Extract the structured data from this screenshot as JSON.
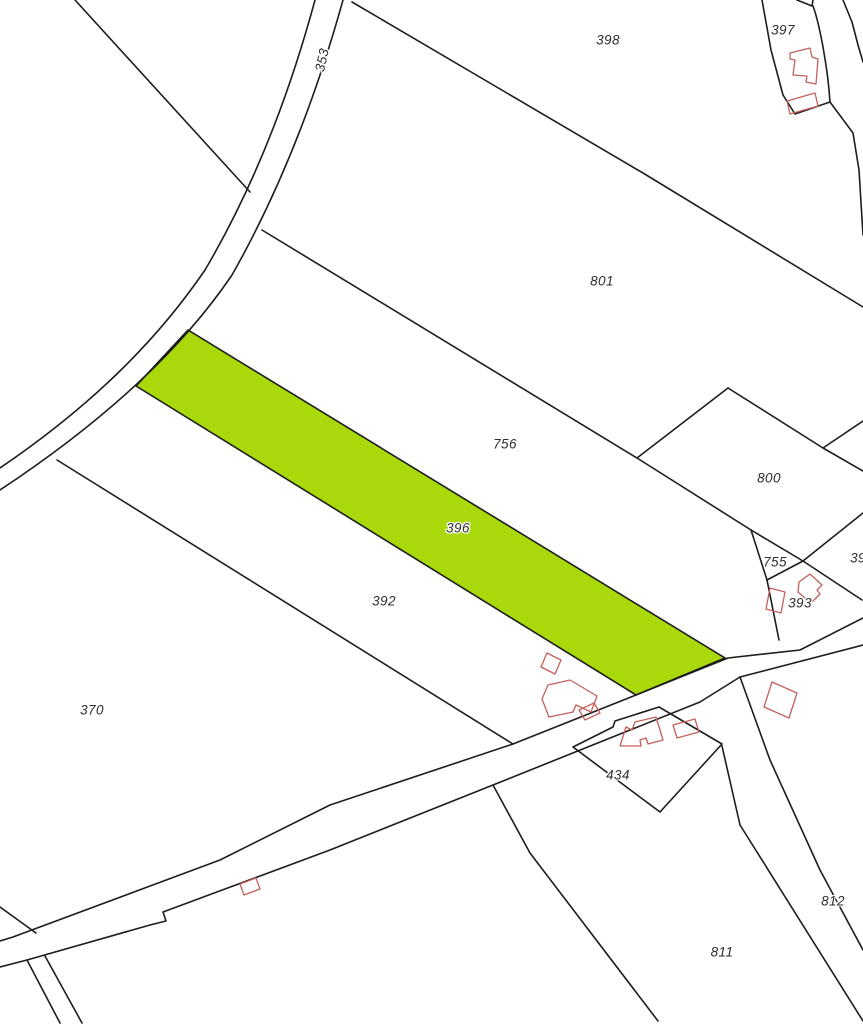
{
  "map": {
    "highlighted_parcel": "396",
    "colors": {
      "highlight_green": "#a9d90b",
      "building_red": "#c4605c",
      "boundary_black": "#1d1d1d",
      "background": "#ffffff"
    },
    "labels": [
      {
        "text": "398"
      },
      {
        "text": "397"
      },
      {
        "text": "353"
      },
      {
        "text": "801"
      },
      {
        "text": "756"
      },
      {
        "text": "800"
      },
      {
        "text": "396"
      },
      {
        "text": "755"
      },
      {
        "text": "39"
      },
      {
        "text": "393"
      },
      {
        "text": "392"
      },
      {
        "text": "370"
      },
      {
        "text": "434"
      },
      {
        "text": "812"
      },
      {
        "text": "811"
      }
    ]
  }
}
